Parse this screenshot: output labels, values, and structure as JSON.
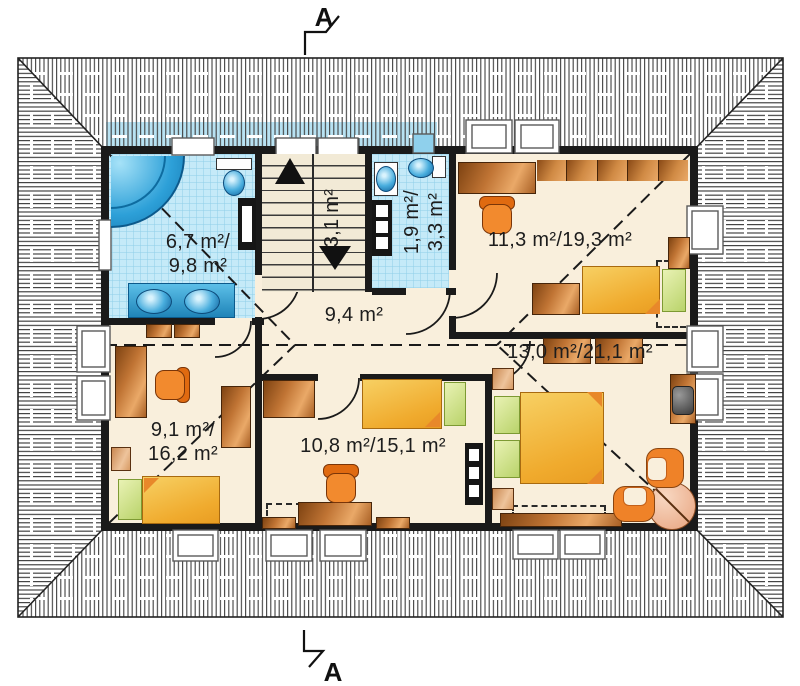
{
  "plan": {
    "title": "attic-floor-plan",
    "section_label": "A",
    "rooms": [
      {
        "key": "bathroom",
        "label": "6,7 m²/\n9,8 m²"
      },
      {
        "key": "stairs",
        "label": "3,1 m²"
      },
      {
        "key": "wc",
        "label": "1,9 m²/\n3,3 m²"
      },
      {
        "key": "bedroom-top-right",
        "label": "11,3 m²/19,3 m²"
      },
      {
        "key": "hall",
        "label": "9,4 m²"
      },
      {
        "key": "bedroom-right",
        "label": "13,0 m²/21,1 m²"
      },
      {
        "key": "bedroom-center",
        "label": "10,8 m²/15,1 m²"
      },
      {
        "key": "bedroom-left",
        "label": "9,1 m²/\n16,2 m²"
      }
    ],
    "colors": {
      "wall": "#1a1a1a",
      "floor": "#f9efdc",
      "tile": "#c5eaf8",
      "tile_grid": "#8ecfe8",
      "water_fixture": "#2da0d8",
      "wood": "#c07434",
      "bed": "#f0ab2e",
      "pillow": "#c4d977",
      "chair": "#f28a2e",
      "hatch_line": "#3f3f3f"
    },
    "icons": {
      "bathtub": "quarter-circle corner tub",
      "toilet": "tank + oval bowl",
      "sink": "oval basin",
      "double-sink-counter": "blue counter with two basins",
      "staircase": "treads with up/down arrows",
      "bed": "yellow mattress with green pillow and folded corner",
      "wardrobe": "wood rectangle",
      "desk": "wood rectangle",
      "office-chair": "orange swivel chair",
      "armchair": "orange U-shape",
      "round-table": "circle with diagonal",
      "tv": "grey box on cabinet",
      "roof-window": "white framed rectangle in roof hatch",
      "section-marker": "zigzag flag with letter A"
    }
  }
}
